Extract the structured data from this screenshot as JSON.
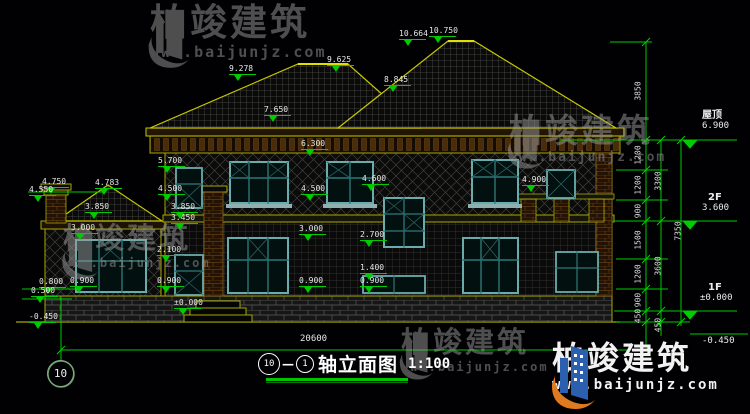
{
  "brand": {
    "name": "柏竣建筑",
    "url": "www.baijunjz.com"
  },
  "title": {
    "axis_from": "10",
    "axis_to": "1",
    "name": "轴立面图",
    "scale": "1:100"
  },
  "axis_bubble": "10",
  "ground_dim": "20600",
  "right_annotations": {
    "roof_label": "屋顶",
    "roof_value": "6.900",
    "f2_label": "2F",
    "f2_value": "3.600",
    "f1_label": "1F",
    "f1_value": "±0.000",
    "below_value": "-0.450"
  },
  "level_markers": [
    {
      "text": "10.664",
      "x": 399,
      "y": 29
    },
    {
      "text": "10.750",
      "x": 429,
      "y": 26
    },
    {
      "text": "9.625",
      "x": 327,
      "y": 55
    },
    {
      "text": "9.278",
      "x": 229,
      "y": 64
    },
    {
      "text": "8.845",
      "x": 384,
      "y": 75
    },
    {
      "text": "7.650",
      "x": 264,
      "y": 105
    },
    {
      "text": "6.300",
      "x": 301,
      "y": 139
    },
    {
      "text": "5.700",
      "x": 158,
      "y": 156
    },
    {
      "text": "4.500",
      "x": 158,
      "y": 184
    },
    {
      "text": "4.500",
      "x": 301,
      "y": 184
    },
    {
      "text": "4.600",
      "x": 362,
      "y": 174
    },
    {
      "text": "4.900",
      "x": 522,
      "y": 175
    },
    {
      "text": "4.783",
      "x": 95,
      "y": 178
    },
    {
      "text": "4.750",
      "x": 42,
      "y": 177
    },
    {
      "text": "4.550",
      "x": 29,
      "y": 185
    },
    {
      "text": "3.850",
      "x": 85,
      "y": 202
    },
    {
      "text": "3.850",
      "x": 171,
      "y": 202
    },
    {
      "text": "3.450",
      "x": 171,
      "y": 213
    },
    {
      "text": "3.000",
      "x": 71,
      "y": 223
    },
    {
      "text": "3.000",
      "x": 299,
      "y": 224
    },
    {
      "text": "2.700",
      "x": 360,
      "y": 230
    },
    {
      "text": "2.100",
      "x": 157,
      "y": 245
    },
    {
      "text": "1.400",
      "x": 360,
      "y": 263
    },
    {
      "text": "0.800",
      "x": 39,
      "y": 277
    },
    {
      "text": "0.900",
      "x": 70,
      "y": 276
    },
    {
      "text": "0.500",
      "x": 31,
      "y": 286
    },
    {
      "text": "0.900",
      "x": 157,
      "y": 276
    },
    {
      "text": "0.900",
      "x": 299,
      "y": 276
    },
    {
      "text": "0.900",
      "x": 360,
      "y": 276
    },
    {
      "text": "±0.000",
      "x": 174,
      "y": 298
    },
    {
      "text": "-0.450",
      "x": 29,
      "y": 312
    }
  ],
  "dim_columns": [
    {
      "x": 638,
      "segments": [
        {
          "v": "3850",
          "mid": 91
        },
        {
          "v": "1200",
          "mid": 155
        },
        {
          "v": "1200",
          "mid": 185
        },
        {
          "v": "900",
          "mid": 211
        },
        {
          "v": "1500",
          "mid": 240
        },
        {
          "v": "1200",
          "mid": 274
        },
        {
          "v": "900",
          "mid": 300
        },
        {
          "v": "450",
          "mid": 316
        }
      ]
    },
    {
      "x": 658,
      "segments": [
        {
          "v": "3300",
          "mid": 181
        },
        {
          "v": "3600",
          "mid": 266
        },
        {
          "v": "450",
          "mid": 325
        }
      ]
    },
    {
      "x": 678,
      "segments": [
        {
          "v": "7350",
          "mid": 231
        }
      ]
    }
  ],
  "colors": {
    "line_yellow": "#a8a800",
    "bright_yellow": "#c8c800",
    "dim_green": "#00cc00",
    "text_white": "#e8e8e8",
    "window_teal": "#6aacac",
    "sill": "#8fb0b0",
    "watermark_gray": "#9a9a9a",
    "logo_blue": "#2b5fb0",
    "logo_orange": "#e07a1e"
  }
}
